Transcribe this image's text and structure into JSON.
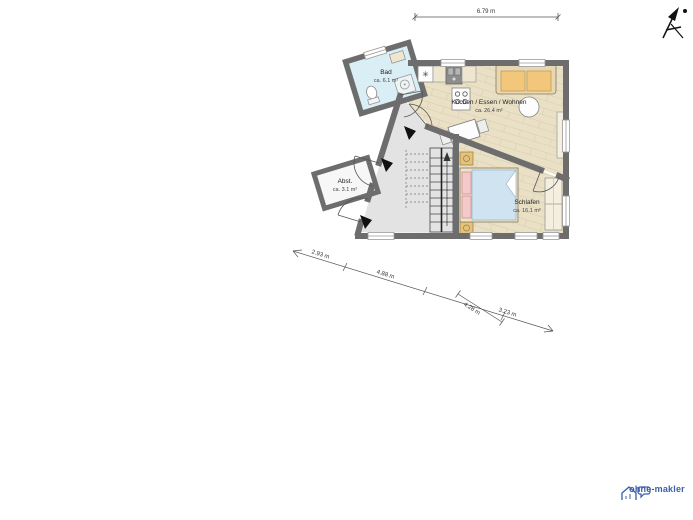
{
  "plan": {
    "rooms": {
      "bad": {
        "name": "Bad",
        "area": "ca. 6.1 m²"
      },
      "wohnen": {
        "name": "Kochen / Essen / Wohnen",
        "area": "ca. 26.4 m²"
      },
      "schlafen": {
        "name": "Schlafen",
        "area": "ca. 16.1 m²"
      },
      "abstellraum": {
        "name": "Abst.",
        "area": "ca. 3.1 m²"
      }
    },
    "dimensions": {
      "top": "6.79 m",
      "diagonal": [
        "2.93 m",
        "4.88 m",
        "4.28 m",
        "3.23 m"
      ]
    },
    "colors": {
      "wall": "#6d6d6d",
      "wood_floor": "#e9e0c6",
      "hall_floor": "#e3e3e3",
      "bath_floor": "#daeef5",
      "sofa_accent": "#f2c77c",
      "bed_blanket": "#cfe4f0",
      "logo_blue": "#3a5ea8"
    }
  },
  "icons": {
    "freezer_symbol": "✳"
  },
  "branding": {
    "logo_text": "ohne-makler"
  }
}
